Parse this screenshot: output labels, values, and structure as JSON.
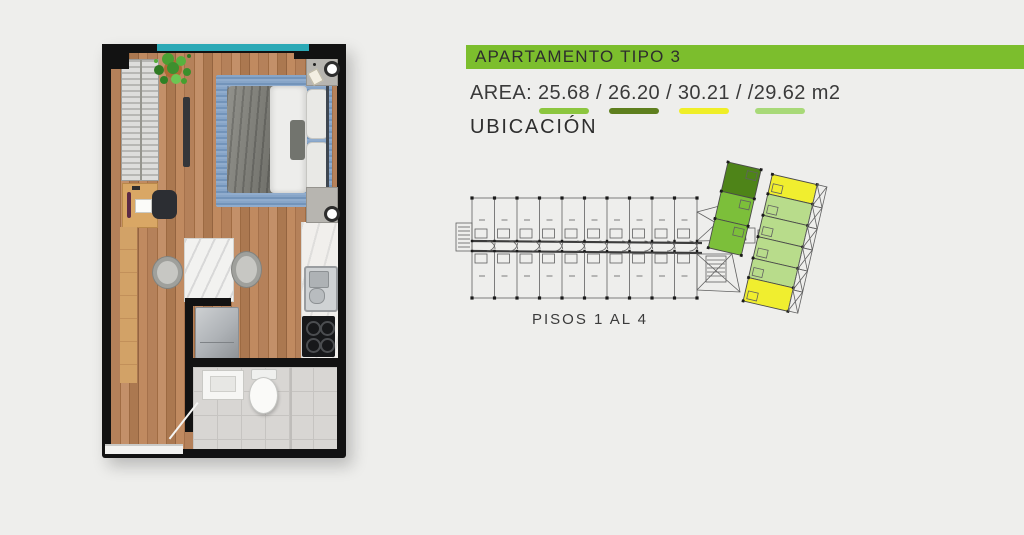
{
  "header": {
    "title": "APARTAMENTO TIPO 3",
    "bar_color": "#7cbe2d",
    "text_color": "#2d2d2d"
  },
  "area": {
    "label": "AREA:",
    "separator": "/",
    "unit": "m2",
    "values": [
      {
        "value": "25.68",
        "swatch": "#8cc63f",
        "prefix": ""
      },
      {
        "value": "26.20",
        "swatch": "#5e7f1e",
        "prefix": ""
      },
      {
        "value": "30.21",
        "swatch": "#efee27",
        "prefix": ""
      },
      {
        "value": "29.62",
        "swatch": "#a8d978",
        "prefix": "/"
      }
    ]
  },
  "location": {
    "heading": "UBICACIÓN",
    "floors_label": "PISOS 1 AL 4"
  },
  "site_plan": {
    "units_per_row": 10,
    "line_color": "#606060",
    "unit_colors": {
      "dark_green": "#4e8418",
      "green": "#7cbf3a",
      "light_green": "#b8dc8b",
      "yellow": "#f0ee2f"
    }
  },
  "floor_plan": {
    "window_color": "#2ba9b6",
    "wall_color": "#121212",
    "wood_color": "#b5815a",
    "rug_color": "#7e9dc1",
    "tile_color": "#d8d6d3"
  }
}
